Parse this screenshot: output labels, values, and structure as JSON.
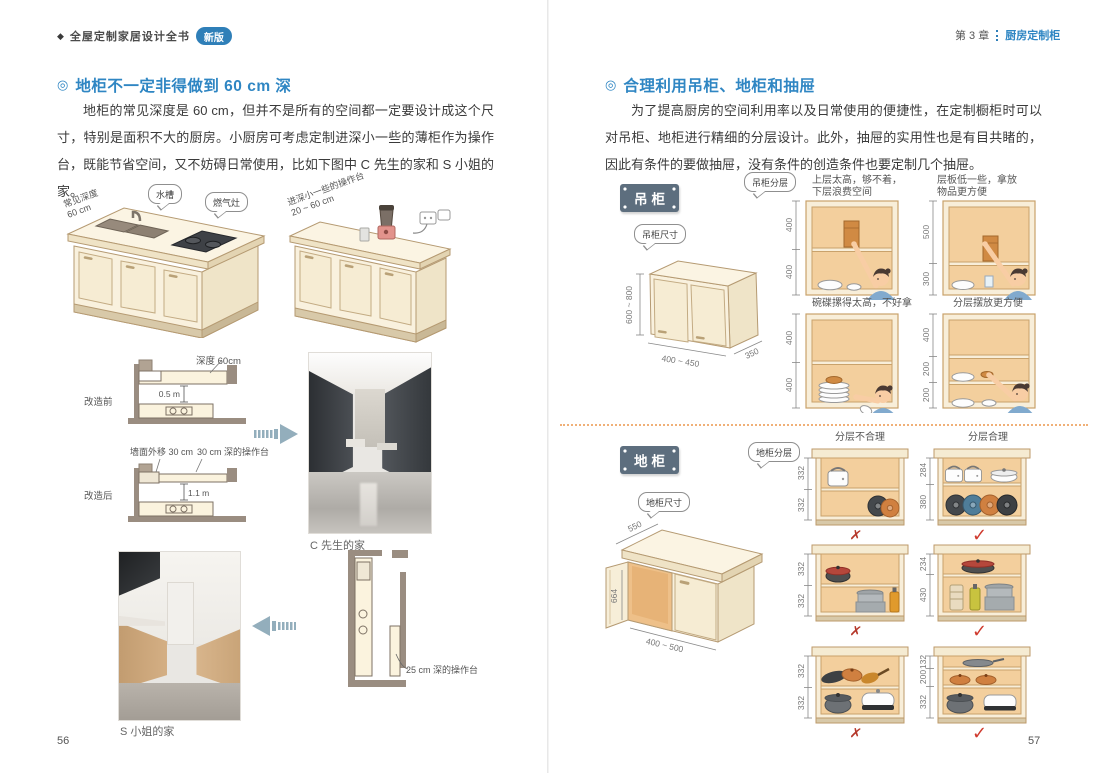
{
  "left": {
    "header_diamond": "◆",
    "header_title": "全屋定制家居设计全书",
    "badge": "新版",
    "title_marker": "◎",
    "title": "地柜不一定非得做到 60 cm 深",
    "para": "地柜的常见深度是 60 cm，但并不是所有的空间都一定要设计成这个尺寸，特别是面积不大的厨房。小厨房可考虑定制进深小一些的薄柜作为操作台，既能节省空间，又不妨碍日常使用，比如下图中 C 先生的家和 S 小姐的家。",
    "fig1": {
      "depth1": "常见深度",
      "depth2": "60 cm",
      "sink": "水槽",
      "stove": "燃气灶"
    },
    "fig2": {
      "label1": "进深小一些的操作台",
      "label2": "20 ~ 60 cm"
    },
    "plan_before": {
      "label": "改造前",
      "depth": "深度 60cm",
      "dim": "0.5 m"
    },
    "plan_after": {
      "label": "改造后",
      "wall": "墙面外移 30 cm",
      "counter": "30 cm 深的操作台",
      "dim": "1.1 m"
    },
    "photo_c": "C 先生的家",
    "photo_s": "S 小姐的家",
    "plan_s": {
      "counter": "25 cm 深的操作台"
    },
    "page": "56"
  },
  "right": {
    "chapter": "第 3 章",
    "chapter_title": "厨房定制柜",
    "title_marker": "◎",
    "title": "合理利用吊柜、地柜和抽屉",
    "para": "为了提高厨房的空间利用率以及日常使用的便捷性，在定制橱柜时可以对吊柜、地柜进行精细的分层设计。此外，抽屉的实用性也是有目共睹的，因此有条件的要做抽屉，没有条件的创造条件也要定制几个抽屉。",
    "wall": {
      "tag": "吊柜",
      "bubble_layers": "吊柜分层",
      "bubble_size": "吊柜尺寸",
      "dim_h": "600 ~ 800",
      "dim_w": "400 ~ 450",
      "dim_d": "350",
      "cells": [
        {
          "cap1": "上层太高，够不着，",
          "cap2": "下层浪费空间",
          "d1": "400",
          "d2": "400"
        },
        {
          "cap1": "层板低一些，拿放",
          "cap2": "物品更方便",
          "d1": "500",
          "d2": "300"
        },
        {
          "cap1": "碗碟摞得太高，不好拿",
          "cap2": "",
          "d1": "400",
          "d2": "400"
        },
        {
          "cap1": "分层摆放更方便",
          "cap2": "",
          "d1": "400",
          "d2": "200",
          "d3": "200"
        }
      ]
    },
    "base": {
      "tag": "地柜",
      "bubble_layers": "地柜分层",
      "bubble_size": "地柜尺寸",
      "dim_top": "550",
      "dim_h": "664",
      "dim_w": "400 ~ 500",
      "header_bad": "分层不合理",
      "header_good": "分层合理",
      "mark_bad": "✗",
      "mark_good": "✓",
      "rows": [
        {
          "bad": [
            "332",
            "332"
          ],
          "good": [
            "284",
            "380"
          ]
        },
        {
          "bad": [
            "332",
            "332"
          ],
          "good": [
            "234",
            "430"
          ]
        },
        {
          "bad": [
            "332",
            "332"
          ],
          "good": [
            "132",
            "200",
            "332"
          ]
        }
      ]
    },
    "page": "57"
  }
}
